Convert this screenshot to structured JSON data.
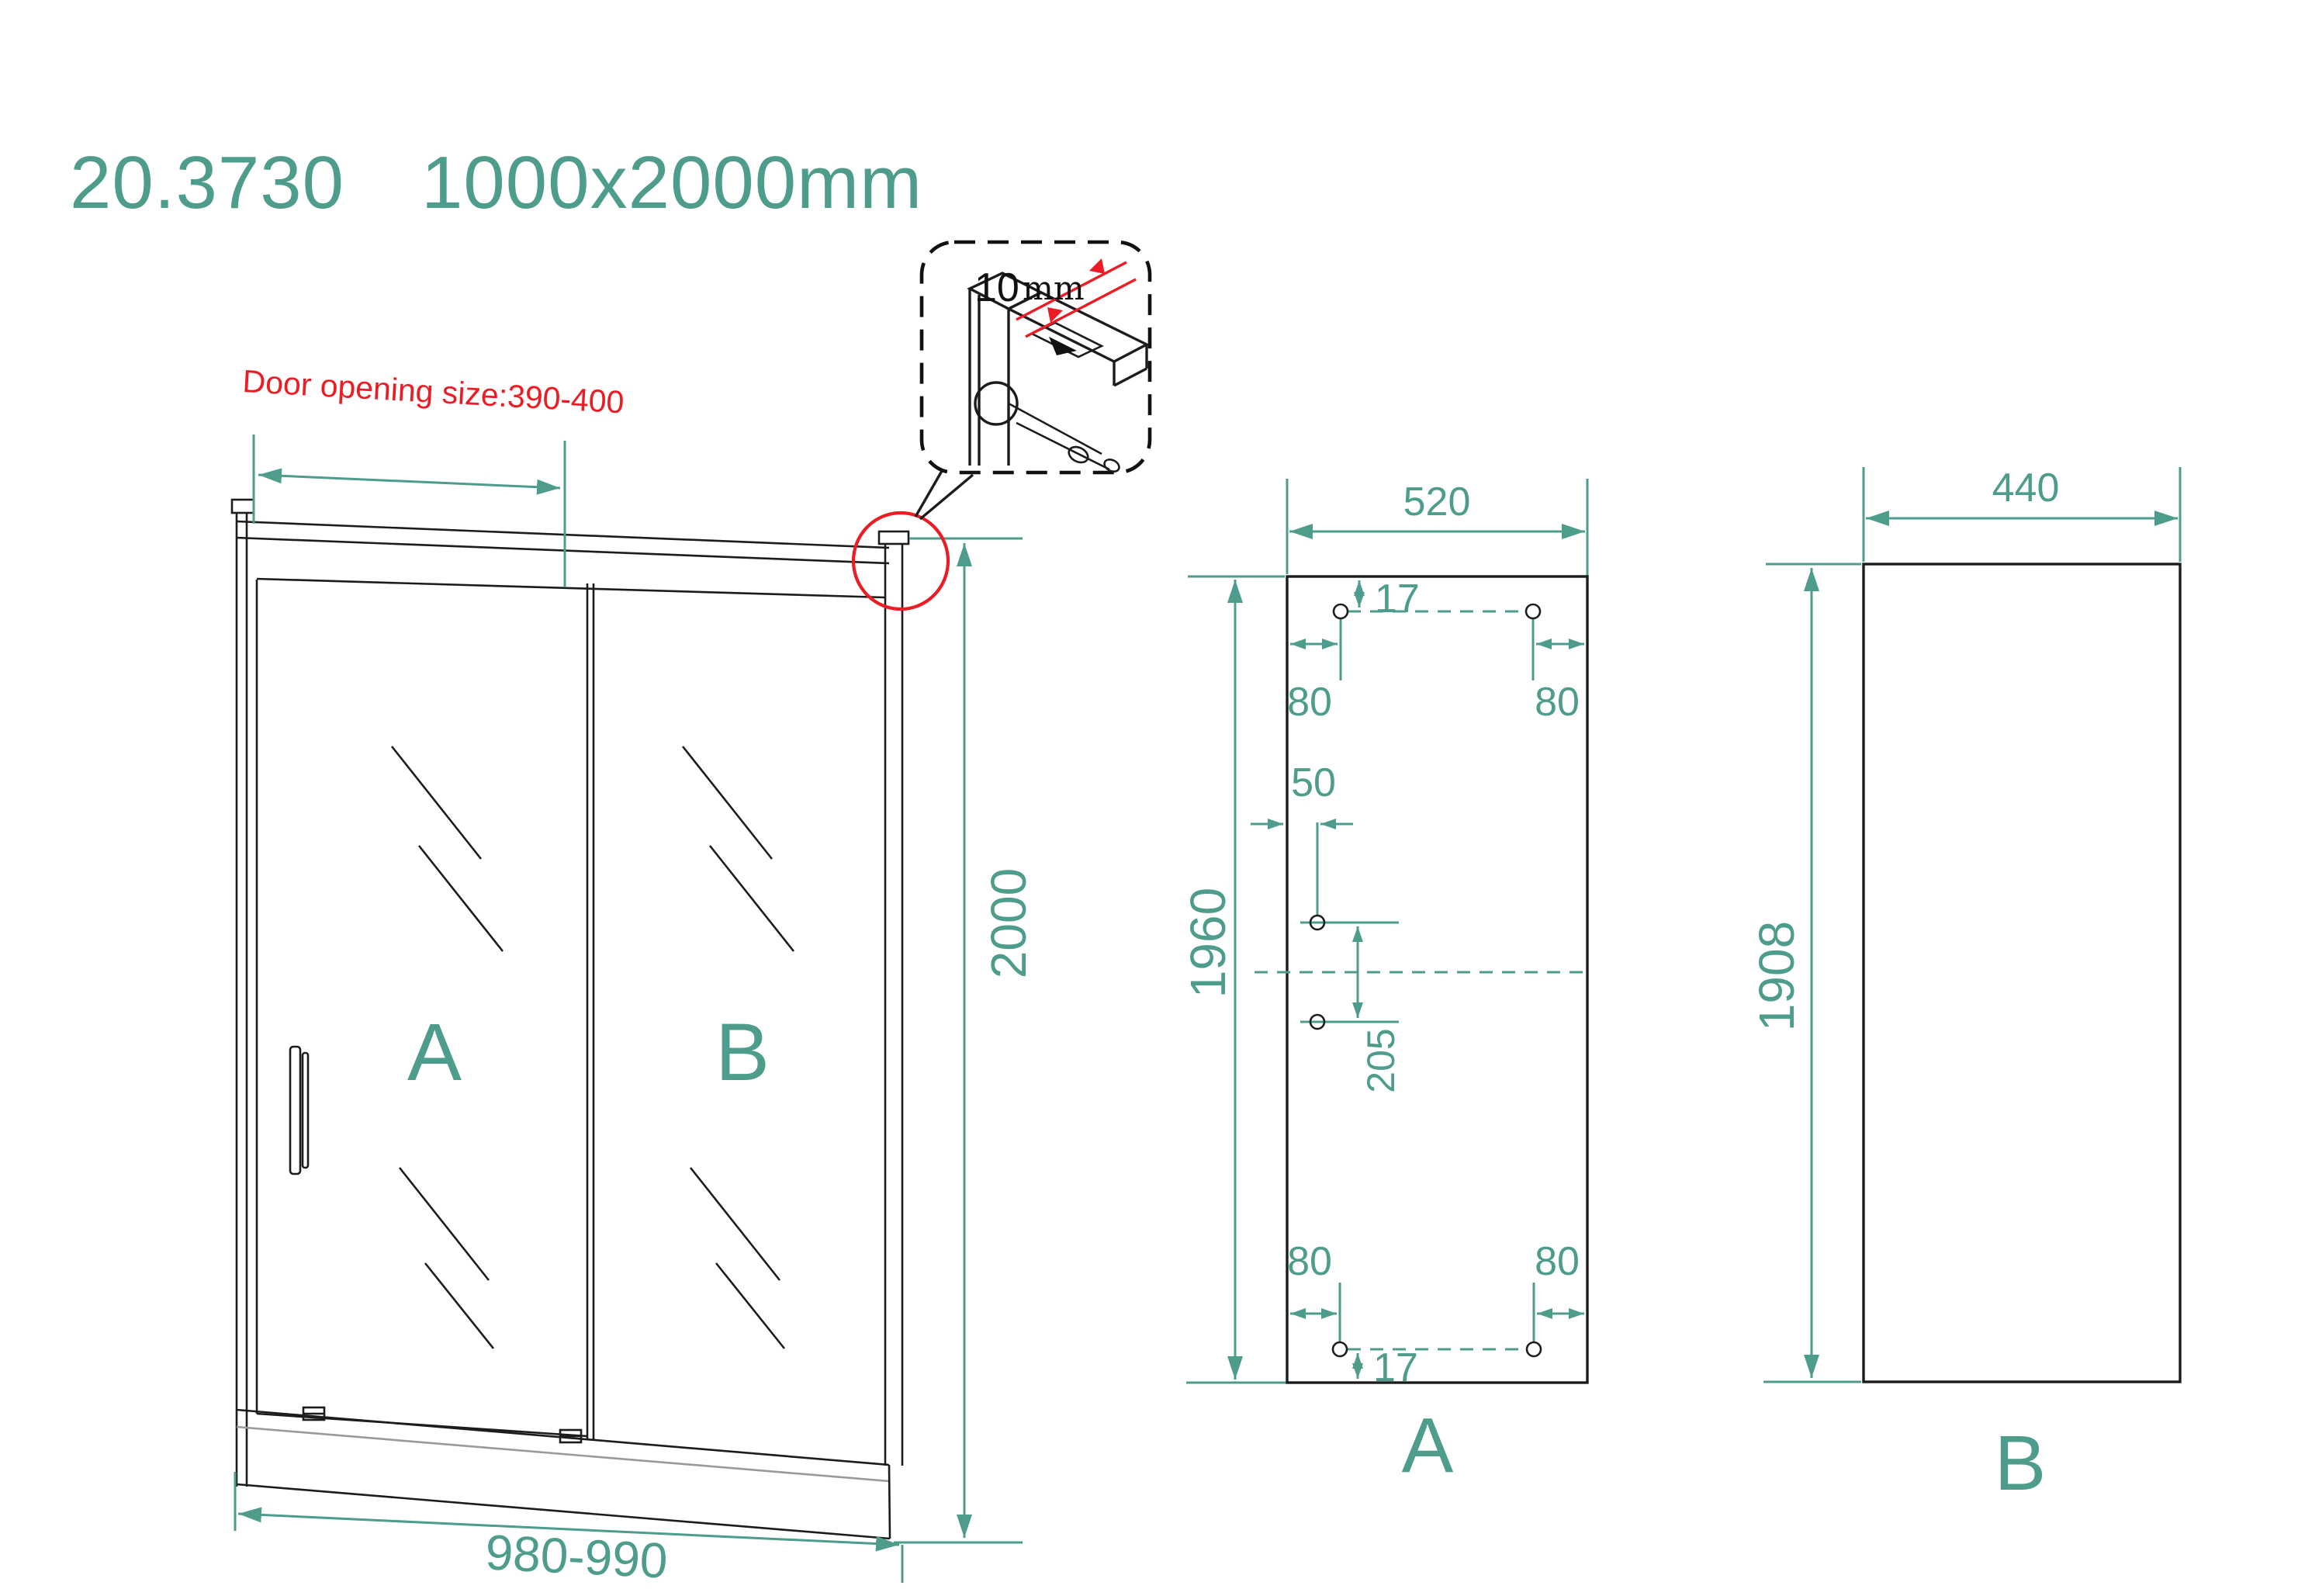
{
  "title": {
    "code": "20.3730",
    "dimensions": "1000x2000mm"
  },
  "colors": {
    "teal": "#4e9d8c",
    "red": "#ec1c24",
    "line": "#1c1c1c",
    "gray": "#9a9a9a"
  },
  "front_view": {
    "door_opening_note": "Door opening size:390-400",
    "glass_a_label": "A",
    "glass_b_label": "B",
    "height_dim": "2000",
    "width_dim": "980-990"
  },
  "detail_callout": {
    "thickness_value": "10",
    "thickness_unit": "mm"
  },
  "panel_a": {
    "name_label": "A",
    "width_dim": "520",
    "height_dim": "1960",
    "top_edge_offset_dim": "17",
    "top_left_hole_dim": "80",
    "top_right_hole_dim": "80",
    "mid_hole_offset_dim": "50",
    "mid_hole_spacing_dim": "205",
    "bottom_left_hole_dim": "80",
    "bottom_right_hole_dim": "80",
    "bottom_edge_offset_dim": "17"
  },
  "panel_b": {
    "name_label": "B",
    "width_dim": "440",
    "height_dim": "1908"
  }
}
